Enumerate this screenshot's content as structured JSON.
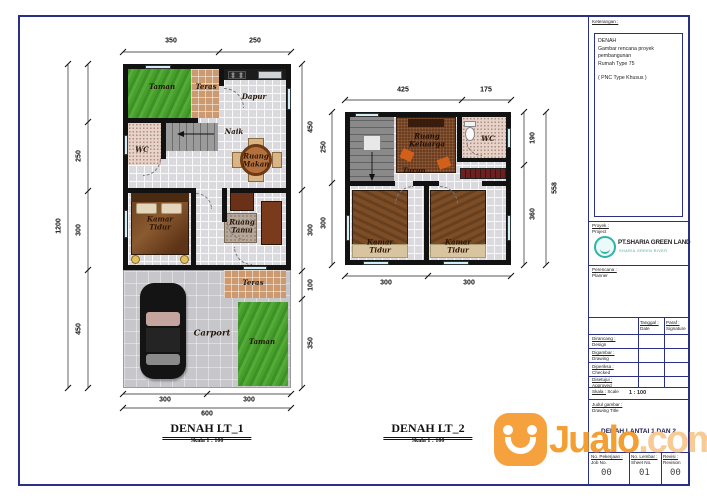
{
  "page": {
    "bg": "#ffffff",
    "border_color": "#2b3087"
  },
  "watermark": {
    "brand": "Jualo",
    "tld": ".com",
    "orange": "#F49F33",
    "tld_color": "#F8CB95"
  },
  "plan1": {
    "title": "DENAH LT_1",
    "scale_note": "Skala 1 : 100",
    "dims": {
      "top": [
        "350",
        "250"
      ],
      "left": [
        "250",
        "300",
        "450"
      ],
      "left_total": "1200",
      "right": [
        "450",
        "300",
        "100",
        "350"
      ],
      "bottom": [
        "300",
        "300"
      ],
      "bottom_total": "600"
    },
    "rooms": {
      "taman_top": "Taman",
      "teras_top": "Teras",
      "dapur": "Dapur",
      "wc": "WC",
      "naik": "Naik",
      "ruang_makan": "Ruang Makan",
      "kamar_tidur": "Kamar Tidur",
      "ruang_tamu": "Ruang Tamu",
      "teras_bottom": "Teras",
      "carport": "Carport",
      "taman_bottom": "Taman"
    }
  },
  "plan2": {
    "title": "DENAH LT_2",
    "scale_note": "Skala 1 : 100",
    "dims": {
      "top": [
        "425",
        "175"
      ],
      "left": [
        "250",
        "300"
      ],
      "right": [
        "190",
        "360"
      ],
      "right_total": "558",
      "bottom": [
        "300",
        "300"
      ]
    },
    "rooms": {
      "ruang_keluarga": "Ruang Keluarga",
      "turun": "Turun",
      "wc": "WC",
      "kamar_tidur_left": "Kamar Tidur",
      "kamar_tidur_right": "Kamar Tidur"
    }
  },
  "titleblock": {
    "keterangan_label": "Keterangan :",
    "notes": {
      "l1": "DENAH",
      "l2": "Gambar rencana proyek pembangunan",
      "l3": "Rumah Type 75",
      "l4": "( PNC Type Khusus )"
    },
    "proyek_label": "Proyek :",
    "project_label": "Project",
    "company": "PT.SHARIA GREEN LAND",
    "company_sub": "SHARIA GREEN RIVER",
    "perencana_label": "Perencana :",
    "planner_label": "Planner",
    "col_tanggal": "Tanggal :",
    "col_tanggal_sub": "Date",
    "col_paraf": "Paraf :",
    "col_paraf_sub": "Signature",
    "row1": "Dirancang :",
    "row1_sub": "Design",
    "row2": "Digambar :",
    "row2_sub": "Drawing",
    "row3": "Diperiksa :",
    "row3_sub": "Checked",
    "row4": "Disetujui :",
    "row4_sub": "Approved",
    "skala_label": "Skala :",
    "scale_sub": "Scale",
    "scale_value": "1 : 100",
    "judul_label": "Judul gambar :",
    "judul_sub": "Drawing Title",
    "drawing_title": "DENAH LANTAI 1 DAN 2",
    "job_label": "No. Pekerjaan :",
    "job_sub": "Job No.",
    "job_value": "00",
    "sheet_label": "No. Lembar :",
    "sheet_sub": "Sheet No.",
    "sheet_value": "01",
    "rev_label": "Revisi :",
    "rev_sub": "Revision",
    "rev_value": "00"
  }
}
